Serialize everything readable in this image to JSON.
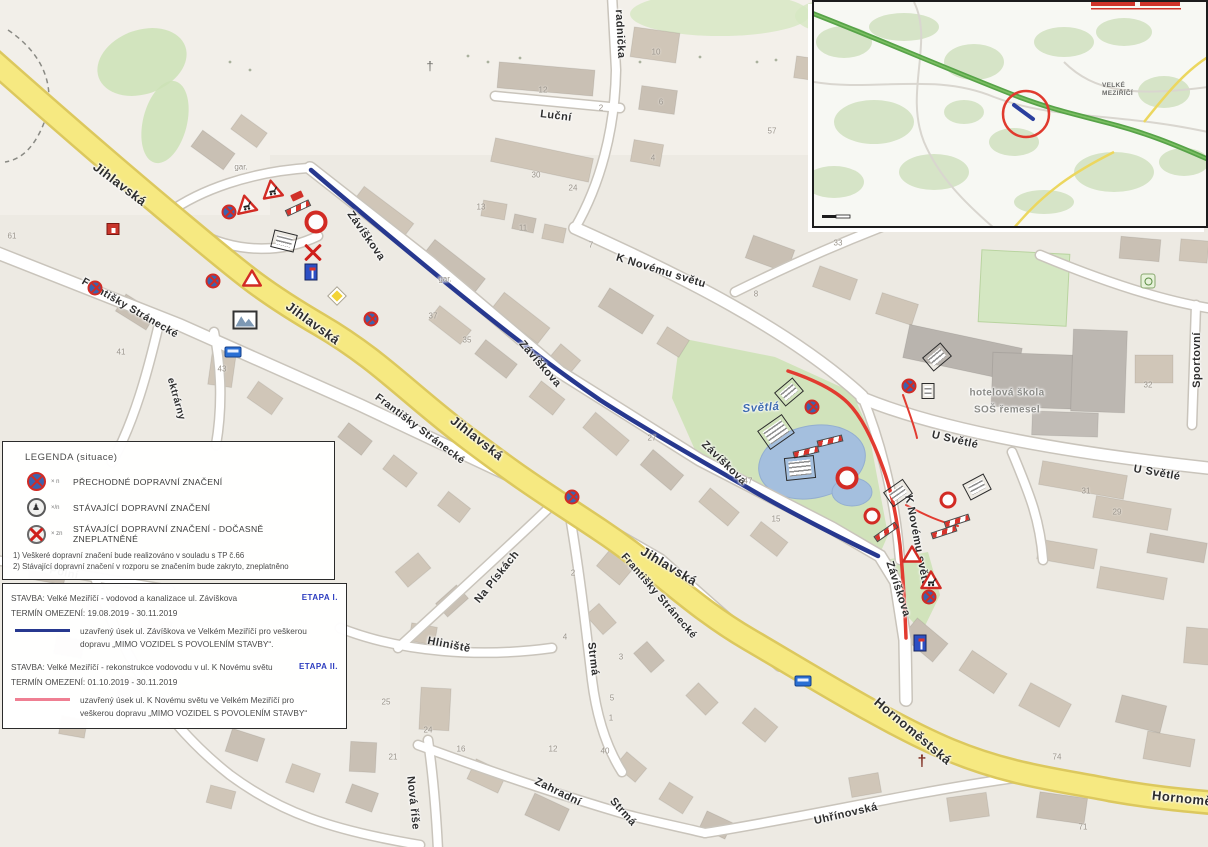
{
  "title": "Dopravně inženýrské opatření – Velké Meziříčí (situace)",
  "colors": {
    "closure_etapa1_blue": "#27388f",
    "closure_etapa2_red": "#e23b30",
    "main_road_yellow": "#f6e981",
    "park_green": "#cde2b6",
    "pond_blue": "#a4bfde"
  },
  "legend": {
    "title": "LEGENDA (situace)",
    "items": [
      {
        "icon": "temporary-sign-icon",
        "code": "× n",
        "label": "PŘECHODNÉ DOPRAVNÍ ZNAČENÍ"
      },
      {
        "icon": "existing-sign-icon",
        "code": "×/n",
        "label": "STÁVAJÍCÍ DOPRAVNÍ ZNAČENÍ"
      },
      {
        "icon": "invalidated-sign-icon",
        "code": "× zn",
        "label": "STÁVAJÍCÍ DOPRAVNÍ ZNAČENÍ - DOČASNĚ ZNEPLATNĚNÉ"
      }
    ],
    "notes": [
      "1) Veškeré dopravní značení bude realizováno v souladu s TP č.66",
      "2) Stávající dopravní značení v rozporu se značením bude zakryto, zneplatněno"
    ]
  },
  "stavba": {
    "entries": [
      {
        "title": "STAVBA: Velké Meziříčí - vodovod a kanalizace ul. Závíškova",
        "etapa": "ETAPA I.",
        "termin": "TERMÍN OMEZENÍ: 19.08.2019 - 30.11.2019",
        "desc": "uzavřený úsek ul. Závíškova ve Velkém Meziříčí pro veškerou dopravu „MIMO VOZIDEL S POVOLENÍM STAVBY“.",
        "line_color": "#27388f"
      },
      {
        "title": "STAVBA: Velké Meziříčí - rekonstrukce vodovodu v ul. K Novému světu",
        "etapa": "ETAPA II.",
        "termin": "TERMÍN OMEZENÍ: 01.10.2019 - 30.11.2019",
        "desc": "uzavřený úsek ul. K Novému světu ve Velkém Meziříčí pro veškerou dopravu „MIMO VOZIDEL S POVOLENÍM STAVBY“",
        "line_color": "#ef7f92"
      }
    ]
  },
  "inset": {
    "town_label_1": "VELKÉ",
    "town_label_2": "MEZIŘÍČÍ"
  },
  "map": {
    "street_labels": [
      {
        "t": "Jihlavská",
        "x": 120,
        "y": 184,
        "r": 37,
        "s": 13
      },
      {
        "t": "Jihlavská",
        "x": 313,
        "y": 323,
        "r": 36,
        "s": 13
      },
      {
        "t": "Jihlavská",
        "x": 477,
        "y": 438,
        "r": 38,
        "s": 13
      },
      {
        "t": "Jihlavská",
        "x": 669,
        "y": 566,
        "r": 31,
        "s": 13
      },
      {
        "t": "Hornoměstská",
        "x": 913,
        "y": 731,
        "r": 40,
        "s": 13
      },
      {
        "t": "Hornoměstská",
        "x": 1200,
        "y": 800,
        "r": 6,
        "s": 13
      },
      {
        "t": "Františky Stránecké",
        "x": 130,
        "y": 308,
        "r": 30,
        "s": 10.5
      },
      {
        "t": "Františky Stránecké",
        "x": 420,
        "y": 429,
        "r": 37,
        "s": 10.5
      },
      {
        "t": "Františky Stránecké",
        "x": 659,
        "y": 596,
        "r": 49,
        "s": 10.5
      },
      {
        "t": "Závíškova",
        "x": 366,
        "y": 236,
        "r": 55,
        "s": 11
      },
      {
        "t": "Závíškova",
        "x": 540,
        "y": 364,
        "r": 49,
        "s": 11
      },
      {
        "t": "Závíškova",
        "x": 724,
        "y": 463,
        "r": 44,
        "s": 11
      },
      {
        "t": "Závíškova",
        "x": 898,
        "y": 589,
        "r": 72,
        "s": 11
      },
      {
        "t": "Luční",
        "x": 556,
        "y": 116,
        "r": 7,
        "s": 11
      },
      {
        "t": "radnička",
        "x": 620,
        "y": 34,
        "r": 87,
        "s": 11
      },
      {
        "t": "K Novému světu",
        "x": 661,
        "y": 271,
        "r": 17,
        "s": 11
      },
      {
        "t": "K Novému světu",
        "x": 917,
        "y": 541,
        "r": 79,
        "s": 11
      },
      {
        "t": "U Světlé",
        "x": 955,
        "y": 440,
        "r": 13,
        "s": 11
      },
      {
        "t": "U Světlé",
        "x": 1157,
        "y": 473,
        "r": 10,
        "s": 11
      },
      {
        "t": "Sportovní",
        "x": 1197,
        "y": 360,
        "r": -90,
        "s": 11
      },
      {
        "t": "Polní",
        "x": 64,
        "y": 573,
        "r": 11,
        "s": 11
      },
      {
        "t": "Na Pískách",
        "x": 497,
        "y": 577,
        "r": -51,
        "s": 11
      },
      {
        "t": "Hliniště",
        "x": 449,
        "y": 645,
        "r": 11,
        "s": 11
      },
      {
        "t": "Strmá",
        "x": 593,
        "y": 659,
        "r": 83,
        "s": 11
      },
      {
        "t": "Strmá",
        "x": 623,
        "y": 812,
        "r": 48,
        "s": 11
      },
      {
        "t": "Zahradní",
        "x": 558,
        "y": 792,
        "r": 26,
        "s": 11
      },
      {
        "t": "Nová říše",
        "x": 413,
        "y": 803,
        "r": 84,
        "s": 11
      },
      {
        "t": "Uhřínovská",
        "x": 846,
        "y": 814,
        "r": -13,
        "s": 11
      },
      {
        "t": "ektrárny",
        "x": 176,
        "y": 399,
        "r": 74,
        "s": 10
      },
      {
        "t": "gar.",
        "x": 241,
        "y": 167,
        "r": 0,
        "s": 8,
        "k": "gray"
      },
      {
        "t": "gar.",
        "x": 445,
        "y": 279,
        "r": 0,
        "s": 8,
        "k": "gray"
      },
      {
        "t": "hotelová škola",
        "x": 1007,
        "y": 393,
        "r": 0,
        "s": 10,
        "k": "school"
      },
      {
        "t": "SOŠ řemesel",
        "x": 1007,
        "y": 410,
        "r": 0,
        "s": 10,
        "k": "school"
      },
      {
        "t": "Světlá",
        "x": 761,
        "y": 408,
        "r": -4,
        "s": 11.5,
        "k": "water"
      }
    ],
    "house_numbers": [
      [
        12,
        236,
        "61"
      ],
      [
        121,
        352,
        "41"
      ],
      [
        222,
        369,
        "43"
      ],
      [
        433,
        316,
        "37"
      ],
      [
        467,
        340,
        "35"
      ],
      [
        838,
        243,
        "33"
      ],
      [
        748,
        481,
        "47"
      ],
      [
        776,
        519,
        "15"
      ],
      [
        652,
        438,
        "27"
      ],
      [
        1086,
        491,
        "31"
      ],
      [
        1117,
        512,
        "29"
      ],
      [
        1148,
        385,
        "32"
      ],
      [
        1057,
        757,
        "74"
      ],
      [
        1083,
        827,
        "71"
      ],
      [
        543,
        90,
        "12"
      ],
      [
        601,
        108,
        "2"
      ],
      [
        656,
        52,
        "10"
      ],
      [
        661,
        102,
        "6"
      ],
      [
        653,
        158,
        "4"
      ],
      [
        772,
        131,
        "57"
      ],
      [
        536,
        175,
        "30"
      ],
      [
        573,
        188,
        "24"
      ],
      [
        481,
        207,
        "13"
      ],
      [
        523,
        228,
        "11"
      ],
      [
        591,
        245,
        "7"
      ],
      [
        756,
        294,
        "8"
      ],
      [
        393,
        757,
        "21"
      ],
      [
        461,
        749,
        "16"
      ],
      [
        553,
        749,
        "12"
      ],
      [
        605,
        751,
        "40"
      ],
      [
        386,
        702,
        "25"
      ],
      [
        428,
        730,
        "24"
      ],
      [
        573,
        573,
        "2"
      ],
      [
        565,
        637,
        "4"
      ],
      [
        621,
        657,
        "3"
      ],
      [
        612,
        698,
        "5"
      ],
      [
        611,
        718,
        "1"
      ]
    ],
    "signs": [
      {
        "t": "tri-works",
        "x": 272,
        "y": 189,
        "r": -10
      },
      {
        "t": "tri-works",
        "x": 246,
        "y": 204,
        "r": -12
      },
      {
        "t": "nostop",
        "x": 229,
        "y": 212
      },
      {
        "t": "redtruck",
        "x": 297,
        "y": 196,
        "r": -25
      },
      {
        "t": "barrier",
        "x": 298,
        "y": 208,
        "r": -25
      },
      {
        "t": "noentry-big",
        "x": 316,
        "y": 222
      },
      {
        "t": "info",
        "x": 284,
        "y": 241,
        "r": 14
      },
      {
        "t": "cross",
        "x": 313,
        "y": 252
      },
      {
        "t": "bluerect",
        "x": 311,
        "y": 272
      },
      {
        "t": "nostop",
        "x": 213,
        "y": 281
      },
      {
        "t": "tri",
        "x": 252,
        "y": 278
      },
      {
        "t": "diamond",
        "x": 337,
        "y": 296
      },
      {
        "t": "nostop",
        "x": 371,
        "y": 319
      },
      {
        "t": "nostop",
        "x": 95,
        "y": 288
      },
      {
        "t": "photo",
        "x": 245,
        "y": 320
      },
      {
        "t": "bus",
        "x": 233,
        "y": 352
      },
      {
        "t": "redhouse",
        "x": 113,
        "y": 229
      },
      {
        "t": "nostop",
        "x": 572,
        "y": 497
      },
      {
        "t": "crossgray",
        "x": 430,
        "y": 66
      },
      {
        "t": "info",
        "x": 789,
        "y": 392,
        "r": -40
      },
      {
        "t": "nostop",
        "x": 812,
        "y": 407
      },
      {
        "t": "info-lg",
        "x": 776,
        "y": 432,
        "r": -35
      },
      {
        "t": "barrier",
        "x": 830,
        "y": 441,
        "r": -14
      },
      {
        "t": "barrier",
        "x": 806,
        "y": 452,
        "r": -14
      },
      {
        "t": "info-lg",
        "x": 800,
        "y": 468,
        "r": -6
      },
      {
        "t": "noentry-big",
        "x": 847,
        "y": 478
      },
      {
        "t": "info",
        "x": 937,
        "y": 357,
        "r": -40
      },
      {
        "t": "nostop",
        "x": 909,
        "y": 386
      },
      {
        "t": "info-sm",
        "x": 928,
        "y": 391
      },
      {
        "t": "info",
        "x": 898,
        "y": 493,
        "r": -35
      },
      {
        "t": "noentry",
        "x": 872,
        "y": 516
      },
      {
        "t": "barrier",
        "x": 886,
        "y": 532,
        "r": -35
      },
      {
        "t": "info",
        "x": 977,
        "y": 487,
        "r": -28
      },
      {
        "t": "noentry",
        "x": 948,
        "y": 500
      },
      {
        "t": "barrier",
        "x": 957,
        "y": 521,
        "r": -18
      },
      {
        "t": "barrier",
        "x": 944,
        "y": 532,
        "r": -18
      },
      {
        "t": "tri",
        "x": 912,
        "y": 554
      },
      {
        "t": "tri-works",
        "x": 931,
        "y": 580
      },
      {
        "t": "nostop",
        "x": 929,
        "y": 597
      },
      {
        "t": "bluerect",
        "x": 920,
        "y": 643
      },
      {
        "t": "church",
        "x": 922,
        "y": 762
      },
      {
        "t": "bus",
        "x": 803,
        "y": 681
      },
      {
        "t": "tennis",
        "x": 1148,
        "y": 281
      }
    ],
    "buildings": [
      [
        193,
        140,
        40,
        20,
        36
      ],
      [
        233,
        122,
        32,
        18,
        36
      ],
      [
        352,
        203,
        62,
        20,
        37
      ],
      [
        422,
        257,
        64,
        20,
        38
      ],
      [
        492,
        308,
        58,
        20,
        38
      ],
      [
        552,
        350,
        26,
        18,
        40
      ],
      [
        600,
        300,
        52,
        22,
        32
      ],
      [
        660,
        332,
        26,
        20,
        32
      ],
      [
        430,
        316,
        40,
        18,
        38
      ],
      [
        476,
        350,
        40,
        18,
        38
      ],
      [
        532,
        388,
        30,
        20,
        38
      ],
      [
        584,
        424,
        44,
        20,
        40
      ],
      [
        642,
        460,
        40,
        20,
        40
      ],
      [
        700,
        498,
        38,
        18,
        40
      ],
      [
        752,
        530,
        34,
        18,
        38
      ],
      [
        498,
        66,
        96,
        26,
        5
      ],
      [
        492,
        148,
        100,
        24,
        12
      ],
      [
        482,
        202,
        24,
        16,
        10
      ],
      [
        513,
        216,
        22,
        15,
        12
      ],
      [
        543,
        226,
        22,
        15,
        12
      ],
      [
        632,
        30,
        46,
        30,
        8
      ],
      [
        640,
        88,
        36,
        24,
        8
      ],
      [
        632,
        142,
        30,
        22,
        10
      ],
      [
        795,
        58,
        32,
        22,
        8
      ],
      [
        748,
        242,
        44,
        24,
        20
      ],
      [
        815,
        272,
        40,
        22,
        20
      ],
      [
        878,
        298,
        38,
        22,
        18
      ],
      [
        905,
        336,
        115,
        34,
        12,
        "#b9b4ae"
      ],
      [
        992,
        354,
        98,
        54,
        2,
        "#b9b4ae"
      ],
      [
        1072,
        330,
        54,
        82,
        2,
        "#bcb7b1"
      ],
      [
        1032,
        412,
        66,
        24,
        2,
        "#c1bcb6"
      ],
      [
        1135,
        355,
        38,
        28,
        0
      ],
      [
        1180,
        240,
        28,
        22,
        5
      ],
      [
        1120,
        238,
        40,
        22,
        5
      ],
      [
        1040,
        468,
        86,
        24,
        10
      ],
      [
        1094,
        502,
        76,
        22,
        10
      ],
      [
        1148,
        538,
        58,
        20,
        10
      ],
      [
        1038,
        544,
        58,
        20,
        10
      ],
      [
        1098,
        572,
        68,
        22,
        10
      ],
      [
        118,
        302,
        36,
        20,
        32
      ],
      [
        210,
        352,
        24,
        34,
        8
      ],
      [
        250,
        388,
        30,
        20,
        35
      ],
      [
        340,
        430,
        30,
        18,
        38
      ],
      [
        385,
        462,
        30,
        18,
        38
      ],
      [
        440,
        498,
        28,
        18,
        38
      ],
      [
        30,
        558,
        36,
        24,
        10
      ],
      [
        88,
        593,
        30,
        20,
        10
      ],
      [
        138,
        618,
        32,
        20,
        15
      ],
      [
        55,
        638,
        28,
        18,
        10
      ],
      [
        118,
        678,
        34,
        24,
        12
      ],
      [
        172,
        703,
        30,
        20,
        15
      ],
      [
        228,
        733,
        34,
        24,
        18
      ],
      [
        60,
        718,
        26,
        18,
        10
      ],
      [
        288,
        768,
        30,
        20,
        20
      ],
      [
        348,
        788,
        28,
        20,
        20
      ],
      [
        208,
        788,
        26,
        18,
        15
      ],
      [
        398,
        560,
        30,
        20,
        -40
      ],
      [
        438,
        592,
        28,
        18,
        -42
      ],
      [
        410,
        625,
        26,
        18,
        10
      ],
      [
        420,
        688,
        30,
        42,
        3
      ],
      [
        350,
        742,
        26,
        30,
        3
      ],
      [
        600,
        556,
        30,
        22,
        40
      ],
      [
        588,
        610,
        26,
        18,
        48
      ],
      [
        636,
        648,
        26,
        18,
        48
      ],
      [
        688,
        690,
        28,
        18,
        45
      ],
      [
        745,
        715,
        30,
        20,
        40
      ],
      [
        905,
        628,
        40,
        24,
        40
      ],
      [
        962,
        660,
        42,
        24,
        34
      ],
      [
        1022,
        692,
        46,
        26,
        28
      ],
      [
        1118,
        700,
        46,
        28,
        14
      ],
      [
        1185,
        628,
        26,
        36,
        5
      ],
      [
        470,
        765,
        34,
        22,
        25
      ],
      [
        528,
        800,
        38,
        24,
        25
      ],
      [
        618,
        758,
        26,
        18,
        40
      ],
      [
        662,
        788,
        28,
        20,
        32
      ],
      [
        702,
        816,
        28,
        18,
        25
      ],
      [
        850,
        775,
        30,
        20,
        -10
      ],
      [
        948,
        795,
        40,
        24,
        -8
      ],
      [
        1038,
        795,
        48,
        26,
        8
      ],
      [
        1145,
        735,
        48,
        28,
        10
      ]
    ]
  }
}
